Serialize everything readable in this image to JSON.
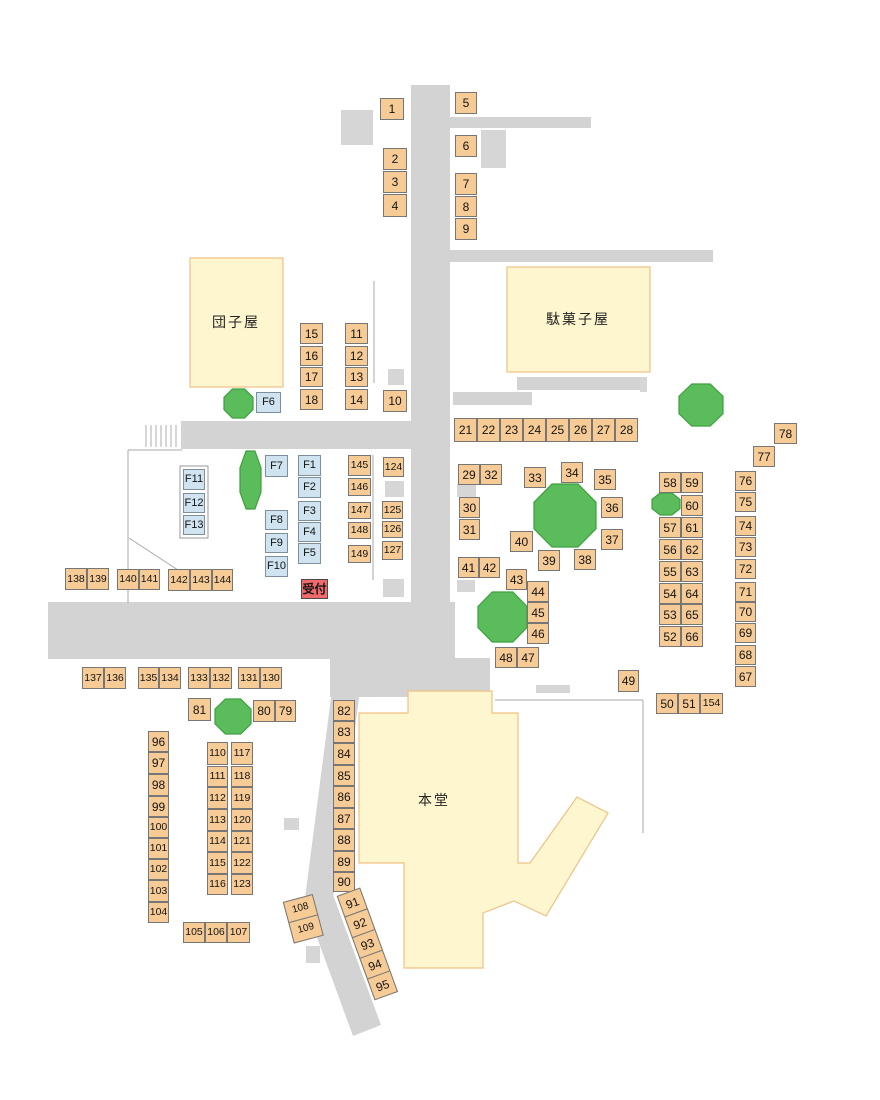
{
  "title": "festival-stall-layout-map",
  "colors": {
    "road": "#d3d3d3",
    "road_square": "#d6d6d6",
    "stall_fill": "#f6cb96",
    "stall_border": "#767676",
    "f_stall_fill": "#cfe3f0",
    "reception_fill": "#f2696c",
    "tree_fill": "#5abc5a",
    "tree_border": "#3da03d",
    "building_fill": "#fdf6cf",
    "building_border": "#f0c184",
    "boundary_line": "#a8a8a8",
    "stairs_line": "#c6c6c6"
  },
  "buildings": {
    "dango": {
      "label": "団子屋",
      "x": 190,
      "y": 258,
      "w": 93,
      "h": 129,
      "label_x": 236,
      "label_y": 322
    },
    "dagashi": {
      "label": "駄菓子屋",
      "x": 507,
      "y": 267,
      "w": 143,
      "h": 105,
      "label_x": 578,
      "label_y": 319
    },
    "hondo": {
      "label": "本堂",
      "polygon": "408,691 492,691 492,713 518,713 518,863 530,863 577,797 608,813 546,916 514,901 483,913 483,968 404,968 404,863 359,863 359,713 408,713",
      "label_x": 434,
      "label_y": 800
    }
  },
  "roads": {
    "rects": [
      [
        411,
        85,
        39,
        523
      ],
      [
        450,
        117,
        141,
        11
      ],
      [
        448,
        250,
        265,
        12
      ],
      [
        517,
        377,
        130,
        13
      ],
      [
        453,
        392,
        79,
        13
      ],
      [
        181,
        421,
        230,
        28
      ],
      [
        48,
        602,
        407,
        57
      ],
      [
        330,
        658,
        160,
        39
      ]
    ],
    "polys": [
      "332,690 360,690 332,906 304,906",
      "304,902 332,892 381,1025 353,1036"
    ]
  },
  "squares": [
    [
      341,
      110,
      32,
      35
    ],
    [
      481,
      130,
      25,
      38
    ],
    [
      388,
      369,
      16,
      16
    ],
    [
      640,
      377,
      7,
      15
    ],
    [
      385,
      481,
      19,
      16
    ],
    [
      457,
      484,
      19,
      13
    ],
    [
      457,
      580,
      18,
      12
    ],
    [
      383,
      579,
      21,
      18
    ],
    [
      536,
      685,
      34,
      8
    ],
    [
      284,
      818,
      15,
      12
    ],
    [
      306,
      946,
      14,
      17
    ]
  ],
  "lines": [
    [
      128,
      450,
      182,
      450
    ],
    [
      128,
      450,
      128,
      603
    ],
    [
      129,
      538,
      184,
      574
    ],
    [
      374,
      281,
      374,
      383
    ],
    [
      373,
      455,
      373,
      580
    ],
    [
      495,
      700,
      643,
      700
    ],
    [
      643,
      700,
      643,
      833
    ]
  ],
  "stairs": {
    "x": 146,
    "step": 5,
    "count": 7,
    "y1": 425,
    "y2": 447
  },
  "f_panel": [
    180,
    466,
    28,
    72
  ],
  "trees": [
    [
      224,
      389,
      29,
      29
    ],
    [
      240,
      451,
      21,
      58
    ],
    [
      679,
      384,
      44,
      42
    ],
    [
      534,
      484,
      62,
      63
    ],
    [
      478,
      592,
      49,
      50
    ],
    [
      652,
      493,
      28,
      22
    ],
    [
      215,
      699,
      36,
      35
    ]
  ],
  "stalls": {
    "format": "[label, x, y, w, h]",
    "items": [
      [
        "1",
        380,
        98,
        24,
        22
      ],
      [
        "5",
        455,
        92,
        22,
        22
      ],
      [
        "2",
        383,
        148,
        24,
        22
      ],
      [
        "3",
        383,
        171,
        24,
        22
      ],
      [
        "4",
        383,
        194,
        24,
        23
      ],
      [
        "6",
        455,
        135,
        22,
        22
      ],
      [
        "7",
        455,
        173,
        22,
        22
      ],
      [
        "8",
        455,
        196,
        22,
        21
      ],
      [
        "9",
        455,
        218,
        22,
        22
      ],
      [
        "15",
        300,
        323,
        23,
        21
      ],
      [
        "16",
        300,
        346,
        23,
        20
      ],
      [
        "17",
        300,
        367,
        23,
        20
      ],
      [
        "18",
        300,
        389,
        23,
        21
      ],
      [
        "11",
        345,
        323,
        23,
        21
      ],
      [
        "12",
        345,
        346,
        23,
        20
      ],
      [
        "13",
        345,
        367,
        23,
        20
      ],
      [
        "14",
        345,
        389,
        23,
        21
      ],
      [
        "10",
        383,
        390,
        24,
        22
      ],
      [
        "F6",
        256,
        392,
        25,
        21
      ],
      [
        "21",
        454,
        418,
        23,
        24
      ],
      [
        "22",
        477,
        418,
        23,
        24
      ],
      [
        "23",
        500,
        418,
        23,
        24
      ],
      [
        "24",
        523,
        418,
        23,
        24
      ],
      [
        "25",
        546,
        418,
        23,
        24
      ],
      [
        "26",
        569,
        418,
        23,
        24
      ],
      [
        "27",
        592,
        418,
        23,
        24
      ],
      [
        "28",
        615,
        418,
        23,
        24
      ],
      [
        "F11",
        183,
        469,
        22,
        21
      ],
      [
        "F12",
        183,
        493,
        22,
        20
      ],
      [
        "F13",
        183,
        515,
        22,
        20
      ],
      [
        "F7",
        265,
        455,
        23,
        22
      ],
      [
        "F8",
        265,
        510,
        23,
        20
      ],
      [
        "F9",
        265,
        533,
        23,
        20
      ],
      [
        "F10",
        265,
        556,
        23,
        21
      ],
      [
        "F1",
        298,
        455,
        23,
        21
      ],
      [
        "F2",
        298,
        477,
        23,
        21
      ],
      [
        "F3",
        298,
        501,
        23,
        20
      ],
      [
        "F4",
        298,
        522,
        23,
        20
      ],
      [
        "F5",
        298,
        543,
        23,
        21
      ],
      [
        "145",
        348,
        455,
        23,
        21
      ],
      [
        "146",
        348,
        478,
        23,
        18
      ],
      [
        "147",
        348,
        502,
        23,
        17
      ],
      [
        "148",
        348,
        522,
        23,
        17
      ],
      [
        "149",
        348,
        545,
        23,
        18
      ],
      [
        "124",
        383,
        457,
        21,
        20
      ],
      [
        "125",
        382,
        501,
        21,
        18
      ],
      [
        "126",
        382,
        521,
        21,
        17
      ],
      [
        "127",
        382,
        541,
        21,
        19
      ],
      [
        "受付",
        301,
        579,
        27,
        20
      ],
      [
        "138",
        65,
        568,
        22,
        22
      ],
      [
        "139",
        87,
        568,
        22,
        22
      ],
      [
        "140",
        117,
        569,
        22,
        21
      ],
      [
        "141",
        139,
        569,
        21,
        21
      ],
      [
        "142",
        168,
        569,
        22,
        22
      ],
      [
        "143",
        190,
        569,
        22,
        22
      ],
      [
        "144",
        212,
        569,
        21,
        22
      ],
      [
        "29",
        458,
        464,
        22,
        21
      ],
      [
        "32",
        480,
        464,
        22,
        21
      ],
      [
        "30",
        459,
        497,
        21,
        21
      ],
      [
        "31",
        459,
        519,
        21,
        21
      ],
      [
        "33",
        524,
        467,
        22,
        21
      ],
      [
        "34",
        561,
        462,
        22,
        21
      ],
      [
        "35",
        594,
        469,
        22,
        21
      ],
      [
        "36",
        601,
        497,
        22,
        21
      ],
      [
        "37",
        601,
        529,
        22,
        21
      ],
      [
        "40",
        510,
        531,
        23,
        21
      ],
      [
        "39",
        538,
        550,
        22,
        21
      ],
      [
        "38",
        574,
        549,
        22,
        21
      ],
      [
        "41",
        458,
        557,
        21,
        21
      ],
      [
        "42",
        479,
        557,
        21,
        21
      ],
      [
        "43",
        506,
        569,
        21,
        21
      ],
      [
        "44",
        527,
        581,
        22,
        21
      ],
      [
        "45",
        527,
        602,
        22,
        21
      ],
      [
        "46",
        527,
        623,
        22,
        21
      ],
      [
        "48",
        495,
        647,
        22,
        21
      ],
      [
        "47",
        517,
        647,
        22,
        21
      ],
      [
        "49",
        618,
        670,
        21,
        22
      ],
      [
        "58",
        659,
        472,
        22,
        21
      ],
      [
        "59",
        681,
        472,
        22,
        21
      ],
      [
        "60",
        681,
        495,
        22,
        21
      ],
      [
        "57",
        659,
        517,
        22,
        21
      ],
      [
        "61",
        681,
        517,
        22,
        21
      ],
      [
        "56",
        659,
        539,
        22,
        21
      ],
      [
        "62",
        681,
        539,
        22,
        21
      ],
      [
        "55",
        659,
        561,
        22,
        21
      ],
      [
        "63",
        681,
        561,
        22,
        21
      ],
      [
        "54",
        659,
        583,
        22,
        21
      ],
      [
        "64",
        681,
        583,
        22,
        21
      ],
      [
        "53",
        659,
        604,
        22,
        21
      ],
      [
        "65",
        681,
        604,
        22,
        21
      ],
      [
        "52",
        659,
        626,
        22,
        21
      ],
      [
        "66",
        681,
        626,
        22,
        21
      ],
      [
        "78",
        774,
        423,
        23,
        21
      ],
      [
        "77",
        753,
        446,
        22,
        21
      ],
      [
        "76",
        735,
        471,
        21,
        20
      ],
      [
        "75",
        735,
        492,
        21,
        20
      ],
      [
        "74",
        735,
        516,
        21,
        20
      ],
      [
        "73",
        735,
        537,
        21,
        20
      ],
      [
        "72",
        735,
        559,
        21,
        20
      ],
      [
        "71",
        735,
        582,
        21,
        20
      ],
      [
        "70",
        735,
        602,
        21,
        20
      ],
      [
        "69",
        735,
        623,
        21,
        20
      ],
      [
        "68",
        735,
        645,
        21,
        20
      ],
      [
        "67",
        735,
        666,
        21,
        21
      ],
      [
        "50",
        656,
        693,
        22,
        21
      ],
      [
        "51",
        678,
        693,
        22,
        21
      ],
      [
        "154",
        700,
        693,
        23,
        21
      ],
      [
        "137",
        82,
        667,
        22,
        22
      ],
      [
        "136",
        104,
        667,
        22,
        22
      ],
      [
        "135",
        138,
        667,
        21,
        22
      ],
      [
        "134",
        159,
        667,
        22,
        22
      ],
      [
        "133",
        188,
        667,
        22,
        22
      ],
      [
        "132",
        210,
        667,
        22,
        22
      ],
      [
        "131",
        238,
        667,
        22,
        22
      ],
      [
        "130",
        260,
        667,
        22,
        22
      ],
      [
        "81",
        188,
        698,
        23,
        23
      ],
      [
        "80",
        253,
        700,
        22,
        22
      ],
      [
        "79",
        275,
        700,
        21,
        22
      ],
      [
        "82",
        333,
        700,
        22,
        21
      ],
      [
        "83",
        333,
        721,
        22,
        22
      ],
      [
        "84",
        333,
        743,
        22,
        22
      ],
      [
        "85",
        333,
        765,
        22,
        21
      ],
      [
        "86",
        333,
        786,
        22,
        22
      ],
      [
        "87",
        333,
        808,
        22,
        21
      ],
      [
        "88",
        333,
        829,
        22,
        22
      ],
      [
        "89",
        333,
        851,
        22,
        21
      ],
      [
        "90",
        333,
        872,
        22,
        20
      ],
      [
        "96",
        148,
        731,
        21,
        21
      ],
      [
        "97",
        148,
        752,
        21,
        22
      ],
      [
        "98",
        148,
        774,
        21,
        22
      ],
      [
        "99",
        148,
        796,
        21,
        21
      ],
      [
        "100",
        148,
        817,
        21,
        21
      ],
      [
        "101",
        148,
        838,
        21,
        21
      ],
      [
        "102",
        148,
        859,
        21,
        21
      ],
      [
        "103",
        148,
        880,
        21,
        22
      ],
      [
        "104",
        148,
        902,
        21,
        21
      ],
      [
        "110",
        207,
        742,
        21,
        23
      ],
      [
        "111",
        207,
        766,
        21,
        21
      ],
      [
        "112",
        207,
        787,
        21,
        22
      ],
      [
        "113",
        207,
        809,
        21,
        22
      ],
      [
        "114",
        207,
        831,
        21,
        21
      ],
      [
        "115",
        207,
        852,
        21,
        22
      ],
      [
        "116",
        207,
        874,
        21,
        21
      ],
      [
        "117",
        231,
        742,
        22,
        23
      ],
      [
        "118",
        231,
        766,
        22,
        21
      ],
      [
        "119",
        231,
        787,
        22,
        22
      ],
      [
        "120",
        231,
        809,
        22,
        22
      ],
      [
        "121",
        231,
        831,
        22,
        21
      ],
      [
        "122",
        231,
        852,
        22,
        22
      ],
      [
        "123",
        231,
        874,
        22,
        21
      ],
      [
        "105",
        183,
        922,
        22,
        21
      ],
      [
        "106",
        205,
        922,
        22,
        21
      ],
      [
        "107",
        227,
        922,
        23,
        21
      ]
    ]
  },
  "rotated_groups": [
    {
      "labels": [
        "91",
        "92",
        "93",
        "94",
        "95"
      ],
      "x": 337,
      "y": 897,
      "w": 25,
      "box_h": 23,
      "rotate_deg": -20,
      "font": 12
    },
    {
      "labels": [
        "108",
        "109"
      ],
      "x": 283,
      "y": 903,
      "w": 31,
      "box_h": 22,
      "rotate_deg": -15,
      "font": 10
    }
  ]
}
